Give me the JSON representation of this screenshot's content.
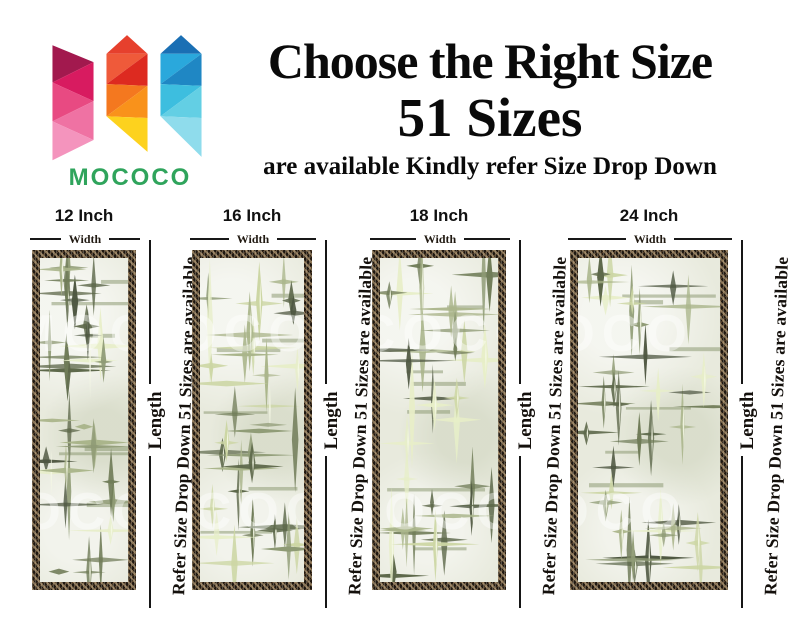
{
  "brand": {
    "name": "MOCOCO",
    "name_color": "#2fa45c",
    "logo_palette": {
      "left_pinks": [
        "#a2194e",
        "#d81b60",
        "#e84a82",
        "#ef72a3",
        "#f494bd"
      ],
      "middle_reds": [
        "#e6402d",
        "#dd2a20",
        "#ef5a3a",
        "#f4781f",
        "#f9921b",
        "#fdd21e"
      ],
      "right_blues": [
        "#1a6fb4",
        "#1f87c4",
        "#2aa8dc",
        "#3dbedf",
        "#63cfe4",
        "#8fdcec"
      ]
    }
  },
  "header": {
    "title": "Choose the Right Size",
    "subtitle": "51 Sizes",
    "note": "are available Kindly refer Size Drop Down",
    "text_color": "#0a0a0a"
  },
  "panels": {
    "width_label": "Width",
    "length_label": "Length",
    "side_note": "Refer Size Drop Down 51 Sizes are available",
    "watermark": "MOCOCO",
    "frame_color": "#1f1811",
    "glass_color": "#e8eadd",
    "cross_palette": [
      "#4e5741",
      "#5d684a",
      "#707c58",
      "#8e9a74",
      "#aab58b",
      "#ccd6a4",
      "#e7eec8"
    ],
    "items": [
      {
        "size_label": "12 Inch"
      },
      {
        "size_label": "16 Inch"
      },
      {
        "size_label": "18 Inch"
      },
      {
        "size_label": "24 Inch"
      }
    ]
  }
}
